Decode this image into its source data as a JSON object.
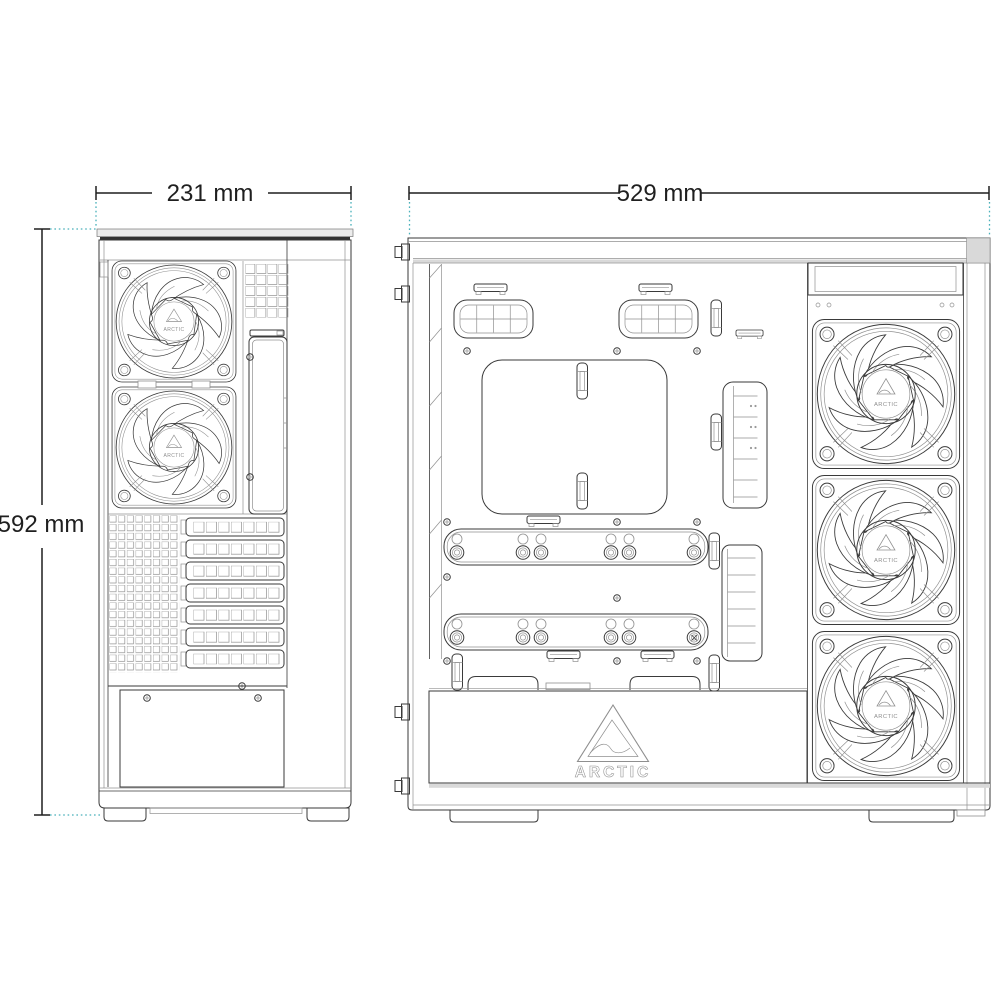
{
  "image": {
    "type": "technical-dimension-diagram",
    "subject": "PC case line drawing, rear view and open side view",
    "background": "#ffffff"
  },
  "brand": {
    "name": "ARCTIC"
  },
  "dimensions": {
    "front_width": {
      "label": "231 mm"
    },
    "side_depth": {
      "label": "529 mm"
    },
    "height": {
      "label": "592 mm"
    }
  },
  "views": {
    "rear": {
      "fan_count": 2,
      "expansion_slot_count": 7,
      "psu_bay": 1
    },
    "side": {
      "fan_count": 3,
      "drive_rail_count": 2,
      "cable_grommet_count": 2
    }
  },
  "colors": {
    "line_dark": "#3a3a3a",
    "line_light": "#909090",
    "dim_line": "#1f1f1f",
    "extension_teal": "#49b0ba",
    "panel_gray": "#d9d9d9",
    "top_bar_gray": "#ececec"
  }
}
